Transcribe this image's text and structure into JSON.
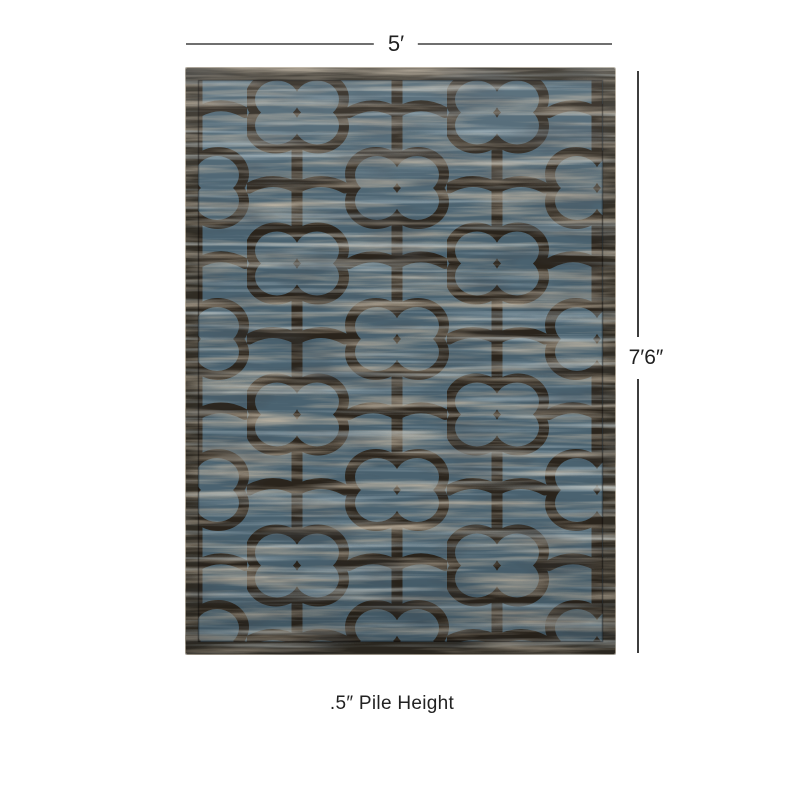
{
  "page": {
    "background": "#ffffff"
  },
  "diagram": {
    "width_label": "5′",
    "height_label": "7′6″",
    "pile_height_label": ".5″ Pile Height"
  },
  "rug": {
    "pattern_name": "quatrefoil-trellis",
    "colors": {
      "field": "#4a6270",
      "field_light": "#7f97a1",
      "streak_tan": "#8d7c63",
      "pattern": "#2a241c",
      "border": "#302c24",
      "edge_highlight": "#aaa294"
    }
  },
  "annotation": {
    "line_color_top": "#6f6f6f",
    "line_color_side": "#3d3d3d",
    "text_color": "#1f1f1f"
  }
}
